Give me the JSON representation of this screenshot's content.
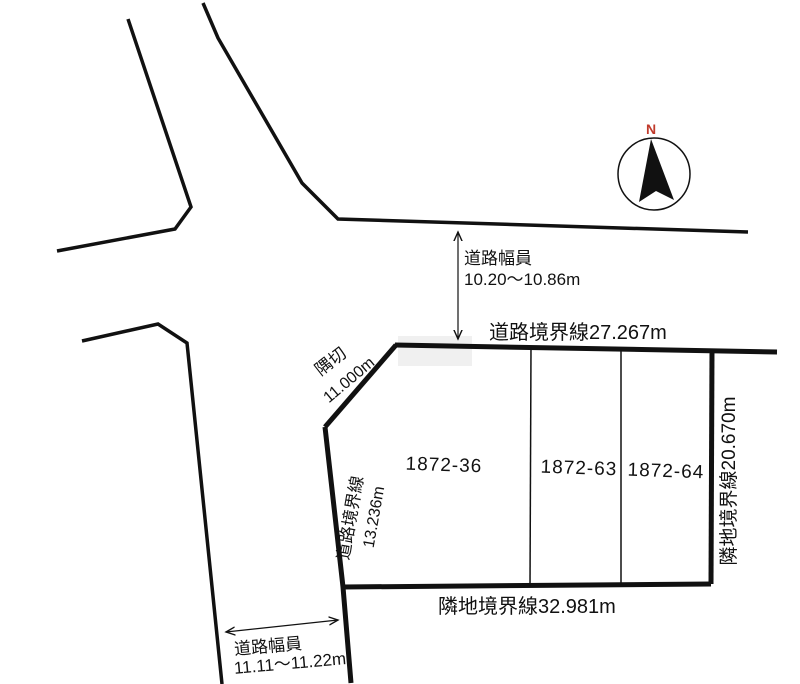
{
  "compass": {
    "north_label": "N"
  },
  "roads": {
    "top": {
      "width_caption": "道路幅員",
      "width_value": "10.20〜10.86m"
    },
    "left": {
      "width_caption": "道路幅員",
      "width_value": "11.11〜11.22m"
    }
  },
  "boundaries": {
    "road_boundary_top": "道路境界線27.267m",
    "corner_cut_label": "隅切",
    "corner_cut_value": "11.000m",
    "road_boundary_left_label": "道路境界線",
    "road_boundary_left_value": "13.236m",
    "adjacent_boundary_right": "隣地境界線20.670m",
    "adjacent_boundary_bottom": "隣地境界線32.981m"
  },
  "parcels": [
    {
      "id": "1872-36"
    },
    {
      "id": "1872-63"
    },
    {
      "id": "1872-64"
    }
  ],
  "colors": {
    "line": "#111111",
    "north": "#c03a2b",
    "background": "#ffffff",
    "patch": "#f0f0f0"
  }
}
